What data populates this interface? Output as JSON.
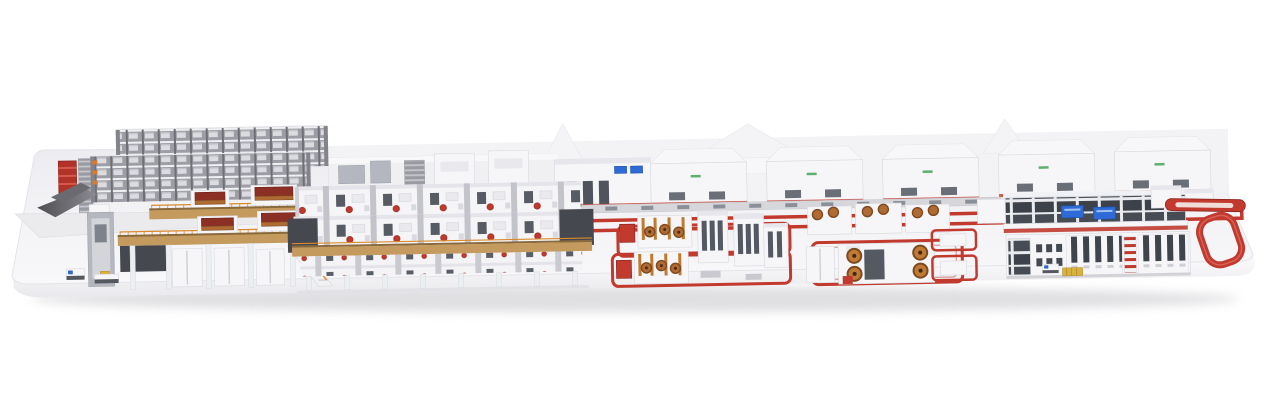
{
  "meta": {
    "description": "3D rendered overview of a complete industrial production line displayed on a white rounded plinth: automated rack storage and sheet infeed at the left, a copper-roller mezzanine, a long elevated double-deck processing line, background machine enclosures, central red-marked robot cells with copper coil stations, a two-story control line block, and a red return conveyor loop at the right end."
  },
  "palette": {
    "machineWhite": "#f6f6f9",
    "machineBorder": "#d8d8de",
    "darkPanel": "#45484f",
    "steel": "#b4b7bf",
    "red": "#c23a2e",
    "redDark": "#8e241c",
    "copper": "#b06a33",
    "copperDark": "#7e4a20",
    "railOrange": "#d98a2b",
    "walkwayTan": "#c49a5e",
    "screenBlue": "#2e6bd6",
    "palletYellow": "#d9b13b",
    "logoGreen": "#3a9e4e",
    "platformTop": "#f2f2f5",
    "platformFront": "#fbfbfd",
    "rampGray": "#55555a"
  },
  "scene": {
    "sections": [
      {
        "name": "platform-plinth"
      },
      {
        "name": "automated-rack-storage"
      },
      {
        "name": "red-rack-tower"
      },
      {
        "name": "infeed-sheet-tables"
      },
      {
        "name": "agv-shuttles"
      },
      {
        "name": "copper-roller-mezzanine"
      },
      {
        "name": "elevated-double-deck-line"
      },
      {
        "name": "background-enclosures"
      },
      {
        "name": "center-conveyor"
      },
      {
        "name": "red-floor-lanes"
      },
      {
        "name": "robot-cell-block-1"
      },
      {
        "name": "robot-cell-block-2"
      },
      {
        "name": "two-story-control-block"
      },
      {
        "name": "red-return-loop"
      }
    ]
  }
}
